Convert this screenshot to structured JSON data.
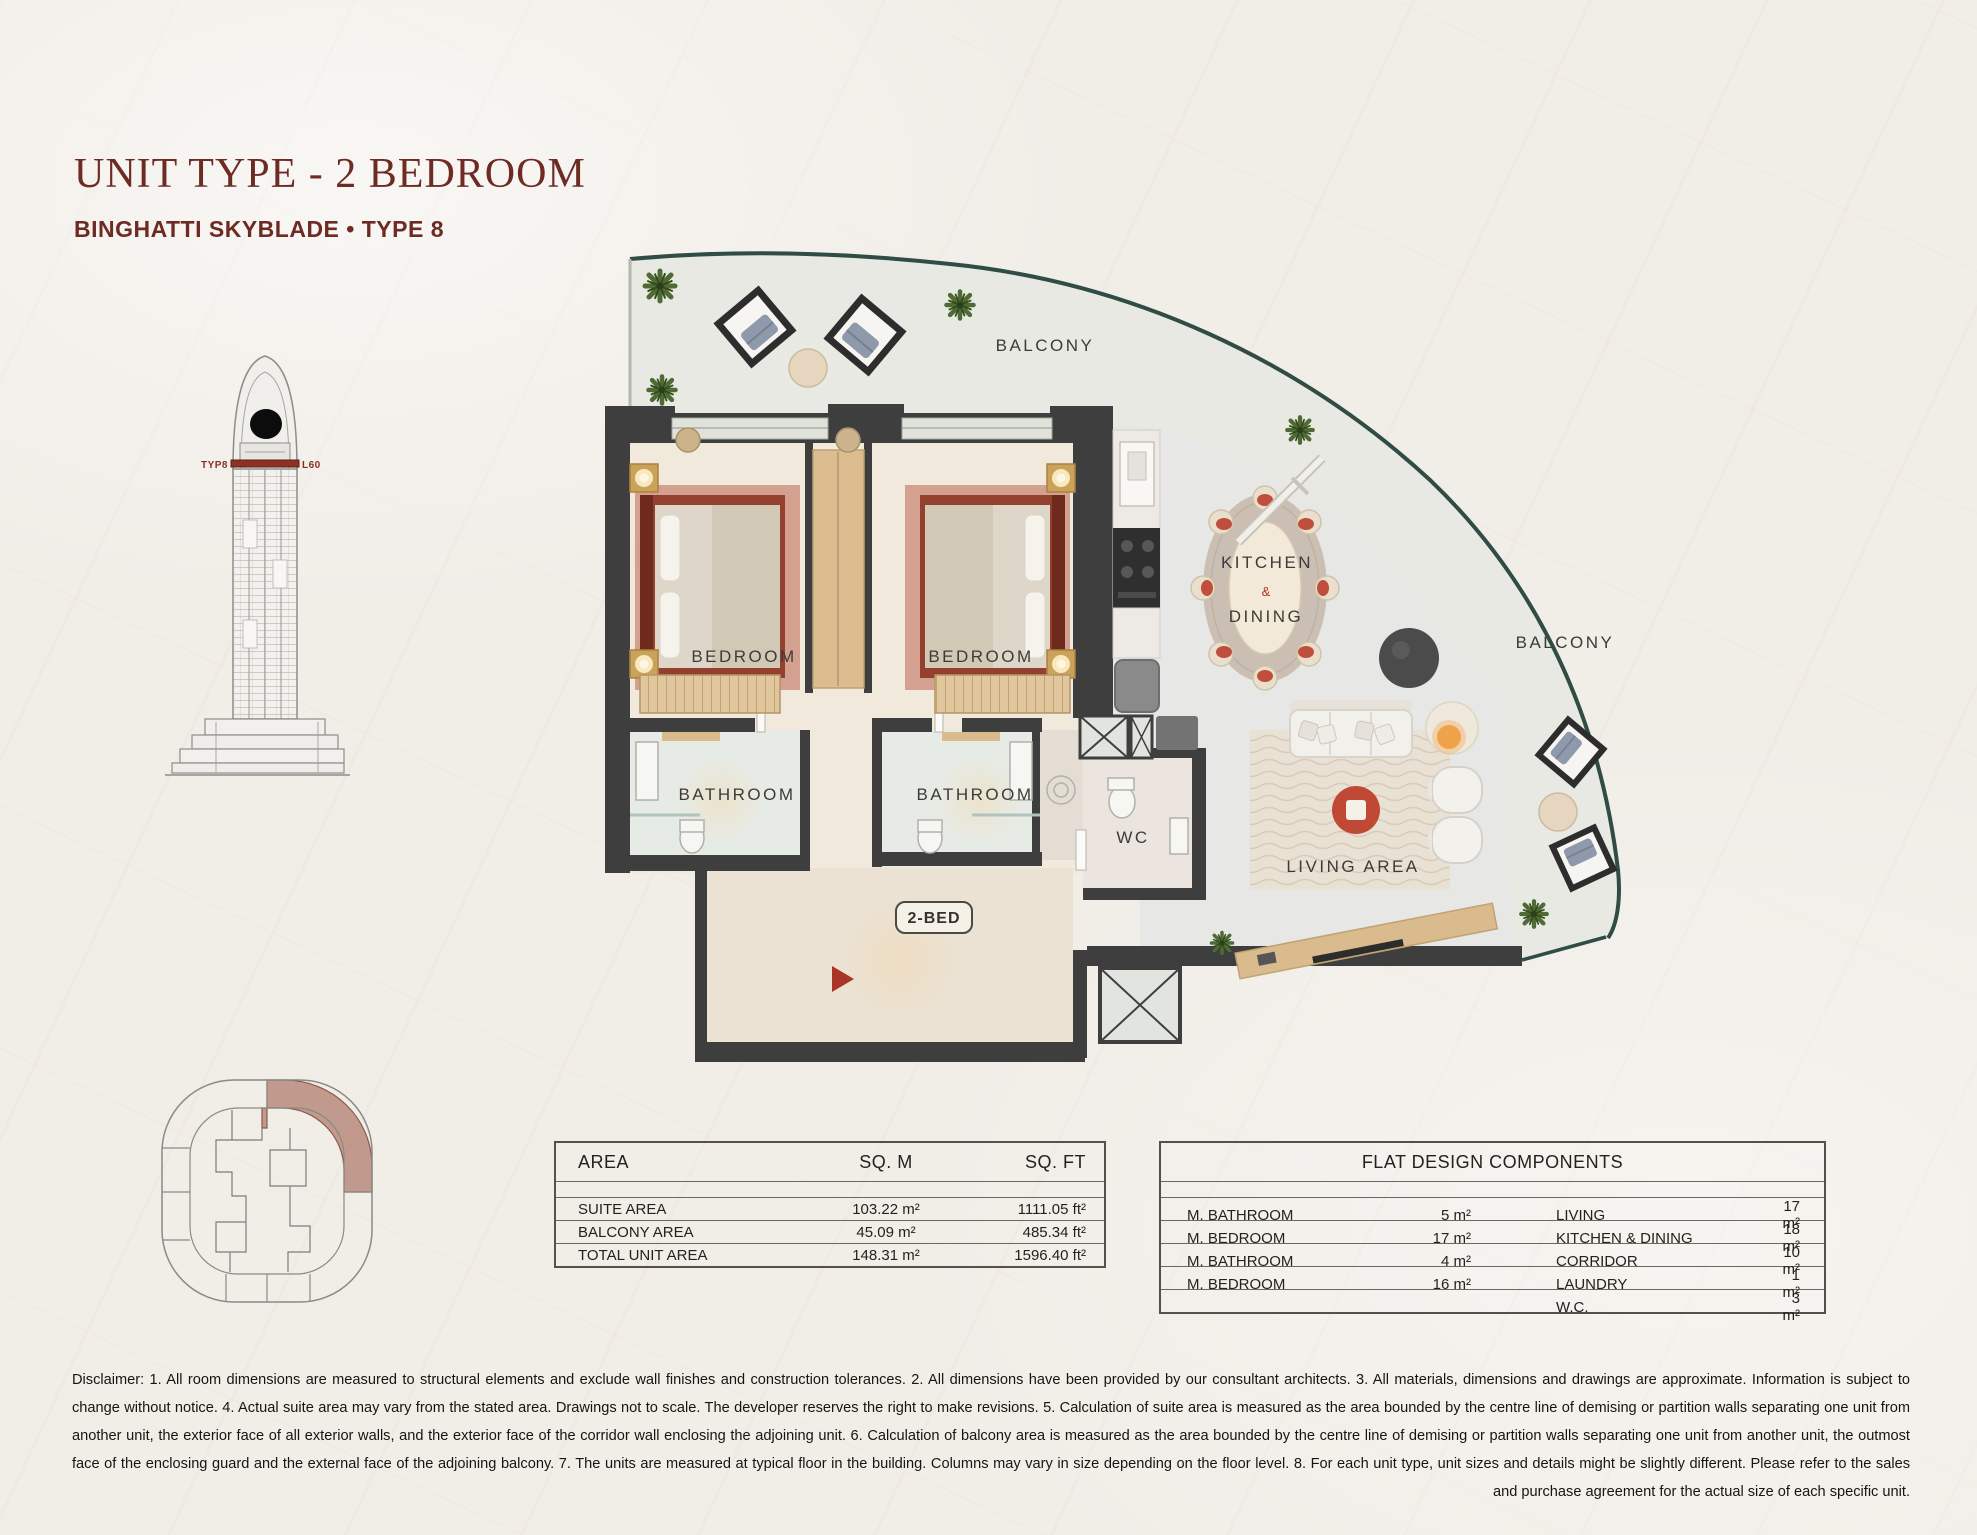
{
  "header": {
    "title": "UNIT TYPE - 2 BEDROOM",
    "subtitle": "BINGHATTI SKYBLADE • TYPE 8"
  },
  "tower": {
    "type_label": "TYP8",
    "level_label": "L60"
  },
  "floorplan": {
    "balcony_top": "BALCONY",
    "balcony_right": "BALCONY",
    "bedroom_1": "BEDROOM",
    "bedroom_2": "BEDROOM",
    "bathroom_1": "BATHROOM",
    "bathroom_2": "BATHROOM",
    "wc": "WC",
    "kitchen": "KITCHEN",
    "amp": "&",
    "dining": "DINING",
    "living": "LIVING AREA",
    "unit_badge": "2-BED"
  },
  "area_table": {
    "headers": [
      "AREA",
      "SQ. M",
      "SQ. FT"
    ],
    "rows": [
      [
        "SUITE AREA",
        "103.22 m²",
        "1111.05 ft²"
      ],
      [
        "BALCONY AREA",
        "45.09 m²",
        "485.34 ft²"
      ],
      [
        "TOTAL UNIT AREA",
        "148.31 m²",
        "1596.40 ft²"
      ]
    ]
  },
  "flat_table": {
    "title": "FLAT DESIGN COMPONENTS",
    "left_rows": [
      {
        "label": "M. BATHROOM",
        "value": "5 m²"
      },
      {
        "label": "M. BEDROOM",
        "value": "17 m²"
      },
      {
        "label": "M. BATHROOM",
        "value": "4 m²"
      },
      {
        "label": "M. BEDROOM",
        "value": "16 m²"
      },
      {
        "label": "",
        "value": ""
      }
    ],
    "right_rows": [
      {
        "label": "LIVING",
        "value": "17 m²"
      },
      {
        "label": "KITCHEN & DINING",
        "value": "18 m²"
      },
      {
        "label": "CORRIDOR",
        "value": "10 m²"
      },
      {
        "label": "LAUNDRY",
        "value": "1 m²"
      },
      {
        "label": "W.C.",
        "value": "3 m²"
      }
    ]
  },
  "disclaimer": "Disclaimer: 1. All room dimensions are measured to structural elements and exclude wall finishes and construction tolerances. 2. All dimensions have been provided by our consultant architects. 3. All materials, dimensions and drawings are approximate. Information is subject to change without notice. 4. Actual suite area may vary from the stated area. Drawings not to scale. The developer reserves the right to make revisions. 5. Calculation of suite area is measured as the area bounded by the centre line of demising or partition walls separating one unit from another unit, the exterior face of all exterior walls, and the exterior face of the corridor wall enclosing the adjoining unit. 6. Calculation of balcony area is measured as the area bounded by the centre line of demising or partition walls separating one unit from another unit, the outmost face of the enclosing guard and the external face of the adjoining balcony. 7. The units are measured at typical floor in the building. Columns may vary in size depending on the floor level. 8. For each unit type, unit sizes and details might be slightly different. Please refer to the sales and purchase agreement for the actual size of each specific unit.",
  "colors": {
    "accent_maroon": "#6e2b24",
    "wall_dark": "#3e3e3e",
    "glass_teal": "#2f4c45",
    "keyplan_highlight": "#b98a7c",
    "entry_marker_red": "#a93527",
    "furniture_red": "#c04936",
    "bed_frame": "#8a3526"
  }
}
